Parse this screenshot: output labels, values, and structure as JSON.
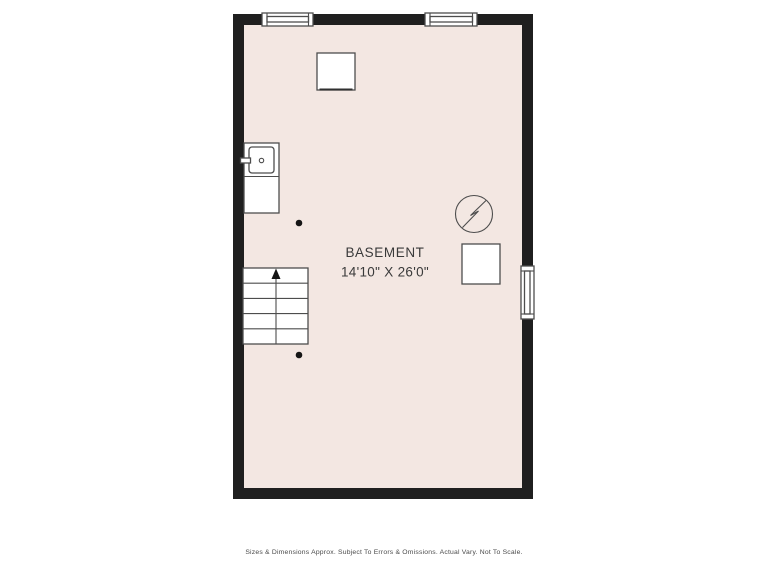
{
  "page": {
    "background_color": "#ffffff",
    "disclaimer": "Sizes & Dimensions Approx. Subject To Errors & Omissions. Actual Vary. Not To Scale."
  },
  "floor_plan": {
    "room": {
      "name": "BASEMENT",
      "dimensions": "14'10\" X 26'0\""
    },
    "colors": {
      "wall": "#1f1f1f",
      "floor": "#f3e7e2",
      "fixture_line": "#4d4d4d",
      "fixture_fill": "#ffffff",
      "label_text": "#3a3a3a",
      "disclaimer_text": "#4a4a4a"
    },
    "symbols": [
      "window-top-left",
      "window-top-right",
      "window-right-wall",
      "appliance-square",
      "laundry-sink",
      "staircase-up",
      "water-heater",
      "furnace-square",
      "support-post-upper",
      "support-post-lower"
    ]
  }
}
